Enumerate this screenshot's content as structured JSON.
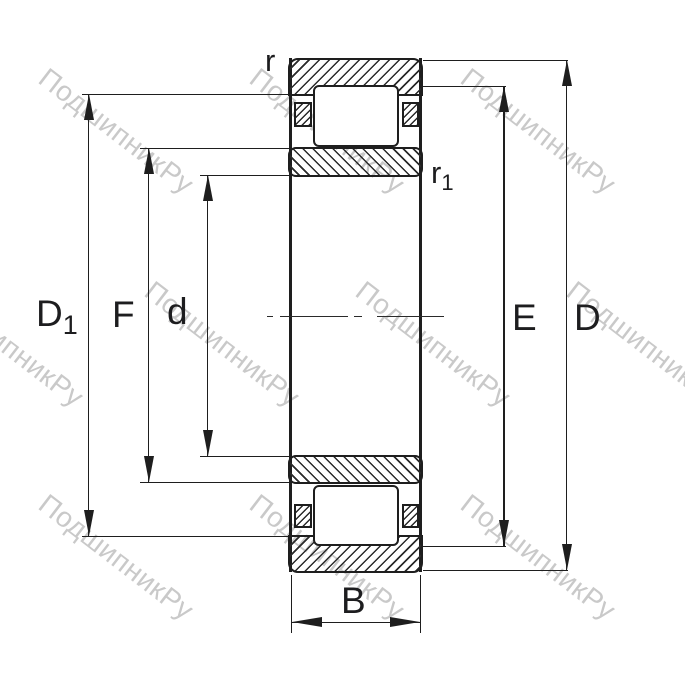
{
  "title": "Cylindrical roller bearing cross-section drawing",
  "watermark": {
    "text": "ПодшипникРу",
    "color": "#c9c9c9"
  },
  "dimensions": {
    "outer_diameter": {
      "label": "D"
    },
    "flange_diameter": {
      "label": "D",
      "sub": "1"
    },
    "outer_raceway": {
      "label": "E"
    },
    "inner_raceway": {
      "label": "F"
    },
    "bore_diameter": {
      "label": "d"
    },
    "width": {
      "label": "B"
    },
    "chamfer_outer": {
      "label": "r"
    },
    "chamfer_inner": {
      "label": "r",
      "sub": "1"
    }
  },
  "colors": {
    "line": "#1e1e1e",
    "watermark": "#c9c9c9",
    "background": "#ffffff"
  }
}
